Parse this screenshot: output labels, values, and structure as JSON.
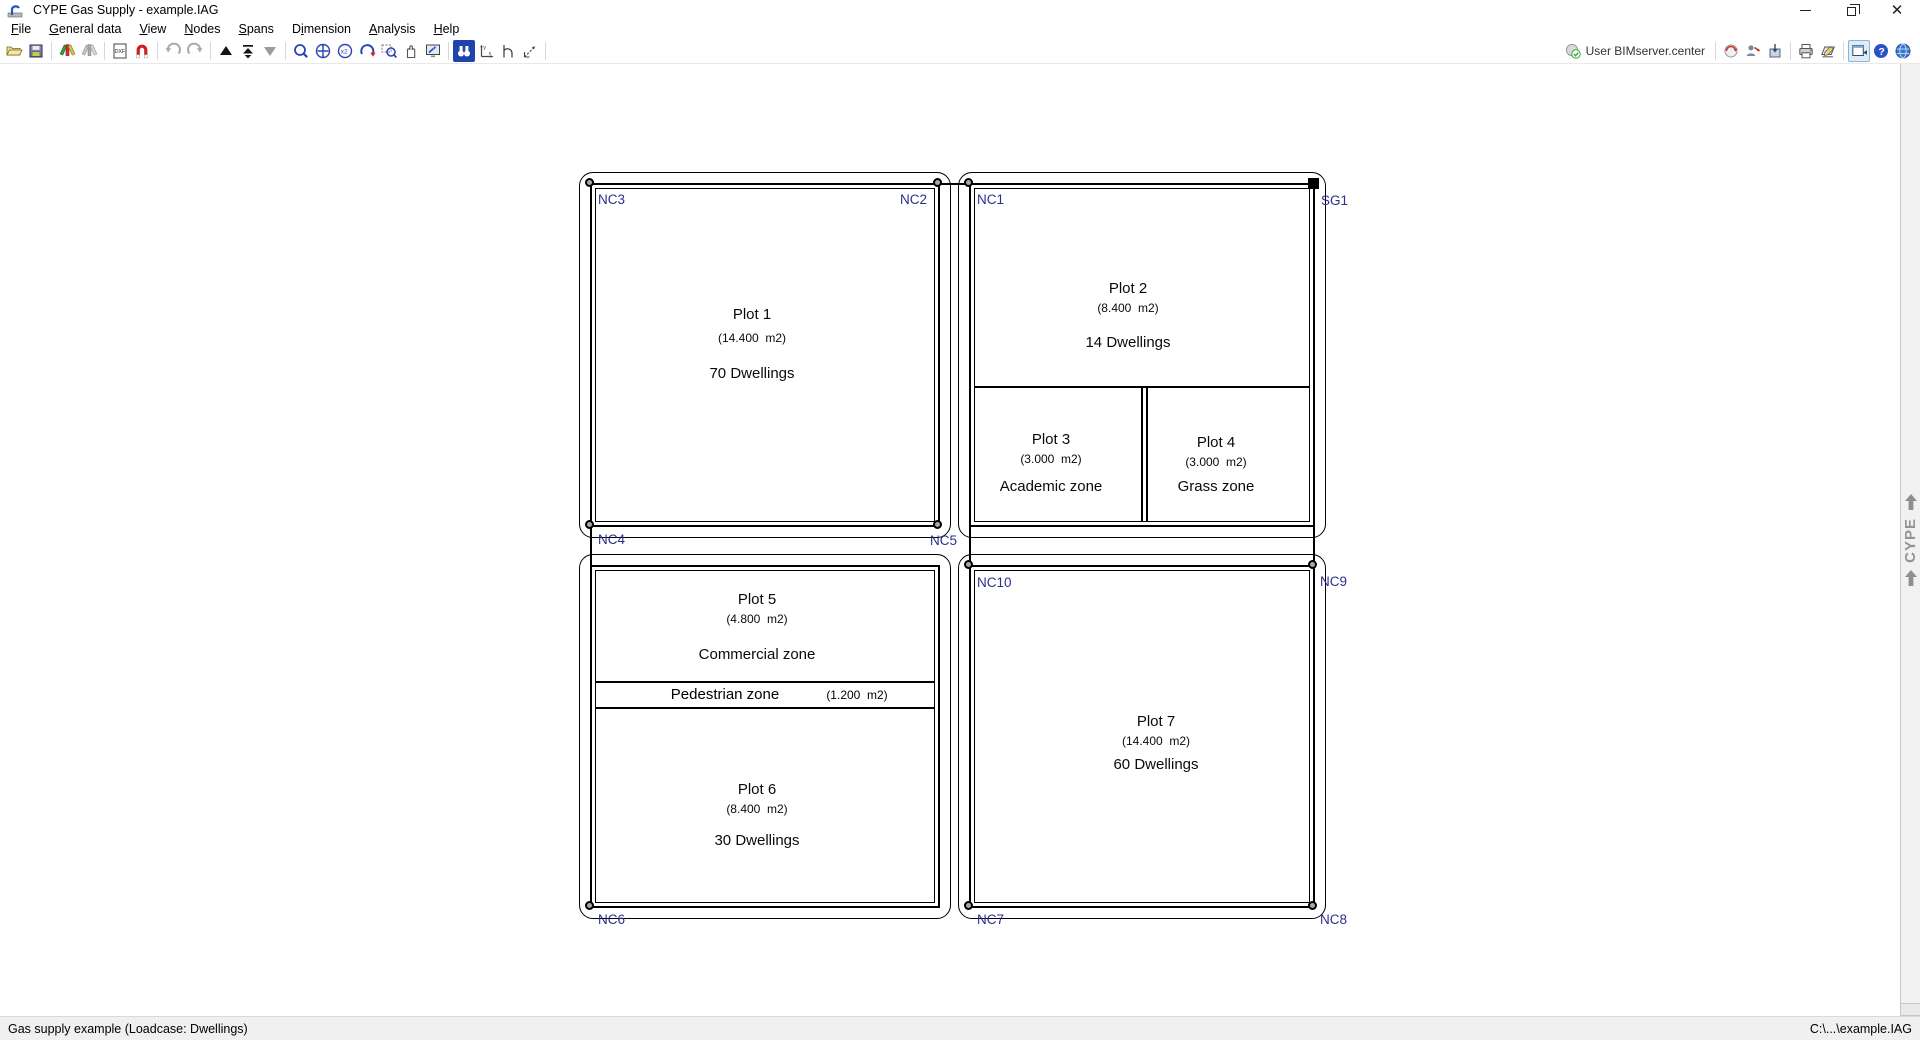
{
  "window": {
    "title": "CYPE Gas Supply - example.IAG"
  },
  "menus": [
    {
      "pre": "",
      "key": "F",
      "post": "ile"
    },
    {
      "pre": "",
      "key": "G",
      "post": "eneral data"
    },
    {
      "pre": "",
      "key": "V",
      "post": "iew"
    },
    {
      "pre": "",
      "key": "N",
      "post": "odes"
    },
    {
      "pre": "",
      "key": "S",
      "post": "pans"
    },
    {
      "pre": "D",
      "key": "i",
      "post": "mension"
    },
    {
      "pre": "",
      "key": "A",
      "post": "nalysis"
    },
    {
      "pre": "",
      "key": "H",
      "post": "elp"
    }
  ],
  "toolbar": {
    "user_label": "User BIMserver.center",
    "left_icons": [
      "open-file",
      "save",
      "edit-tools",
      "edit-tools-disabled",
      "dxf-template",
      "snap-magnet",
      "undo",
      "redo",
      "raise-element",
      "fit-top",
      "lower-element",
      "zoom-previous",
      "zoom-extents",
      "zoom-x2",
      "redraw",
      "zoom-window",
      "pan-hand",
      "full-screen",
      "search-view",
      "axes-origin",
      "snap-reference",
      "measure"
    ],
    "right_icons": [
      "bimserver-sync",
      "user-settings",
      "export-package",
      "print",
      "print-drawing",
      "window-select",
      "help",
      "cype-web"
    ]
  },
  "plots": {
    "plot1": {
      "name": "Plot 1",
      "area": "(14.400  m2)",
      "use": "70 Dwellings"
    },
    "plot2": {
      "name": "Plot 2",
      "area": "(8.400  m2)",
      "use": "14 Dwellings"
    },
    "plot3": {
      "name": "Plot 3",
      "area": "(3.000  m2)",
      "use": "Academic zone"
    },
    "plot4": {
      "name": "Plot 4",
      "area": "(3.000  m2)",
      "use": "Grass zone"
    },
    "plot5": {
      "name": "Plot 5",
      "area": "(4.800  m2)",
      "use": "Commercial zone"
    },
    "pedestrian": {
      "name": "Pedestrian zone",
      "area": "(1.200  m2)"
    },
    "plot6": {
      "name": "Plot 6",
      "area": "(8.400  m2)",
      "use": "30 Dwellings"
    },
    "plot7": {
      "name": "Plot 7",
      "area": "(14.400  m2)",
      "use": "60 Dwellings"
    }
  },
  "nodes": {
    "nc1": "NC1",
    "nc2": "NC2",
    "nc3": "NC3",
    "nc4": "NC4",
    "nc5": "NC5",
    "nc6": "NC6",
    "nc7": "NC7",
    "nc8": "NC8",
    "nc9": "NC9",
    "nc10": "NC10",
    "sg1": "SG1"
  },
  "brand": {
    "text": "CYPE"
  },
  "status": {
    "left": "Gas supply example (Loadcase: Dwellings)",
    "right": "C:\\...\\example.IAG"
  }
}
